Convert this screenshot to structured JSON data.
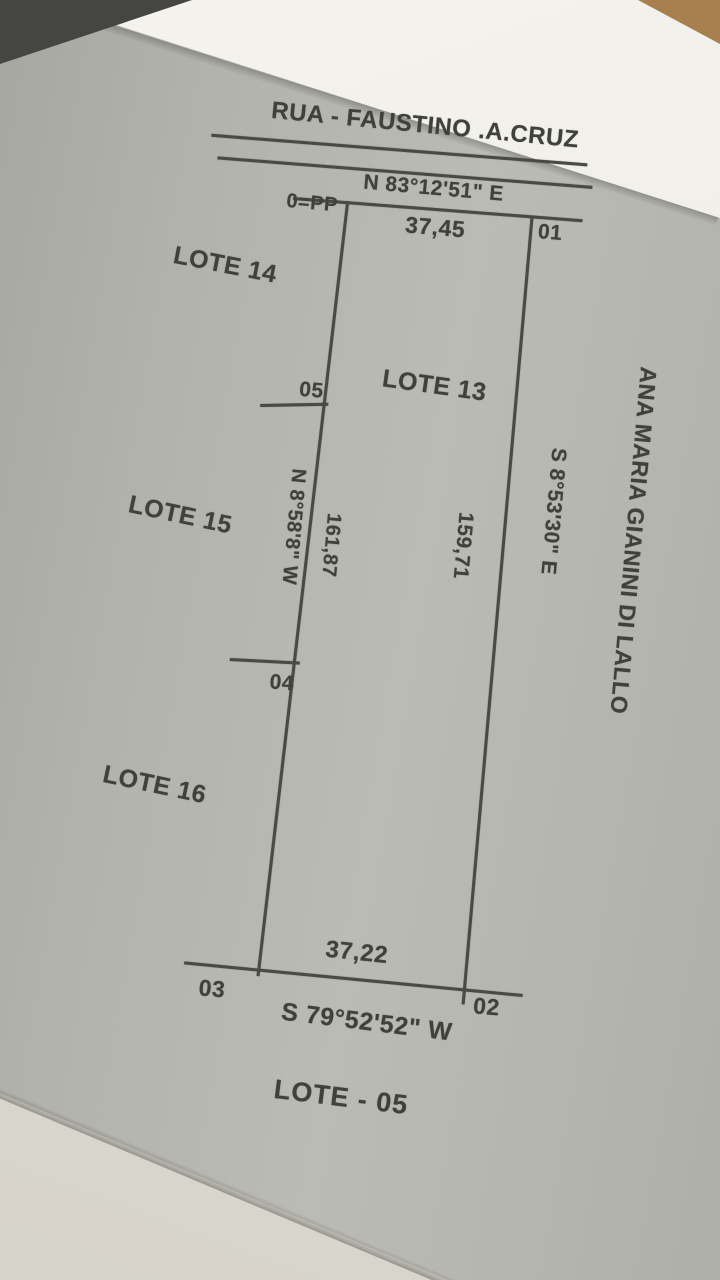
{
  "document": {
    "title": "LOTE - 05",
    "street": {
      "name": "RUA - FAUSTINO .A.CRUZ",
      "bearing": "N 83°12'51\" E"
    },
    "sides": {
      "front": {
        "length": "37,45"
      },
      "back": {
        "length": "37,22",
        "bearing": "S 79°52'52\" W"
      },
      "left": {
        "bearing": "N 8°58'8\" W",
        "length": "161,87"
      },
      "right": {
        "length": "159,71",
        "bearing": "S 8°53'30\" E",
        "adjoiner": "ANA MARIA GIANINI DI LALLO"
      }
    },
    "vertices": {
      "pp": "0=PP",
      "v01": "01",
      "v02": "02",
      "v03": "03",
      "v04": "04",
      "v05": "05"
    },
    "adjoining_lots": {
      "lote13": "LOTE 13",
      "lote14": "LOTE 14",
      "lote15": "LOTE 15",
      "lote16": "LOTE 16"
    }
  }
}
